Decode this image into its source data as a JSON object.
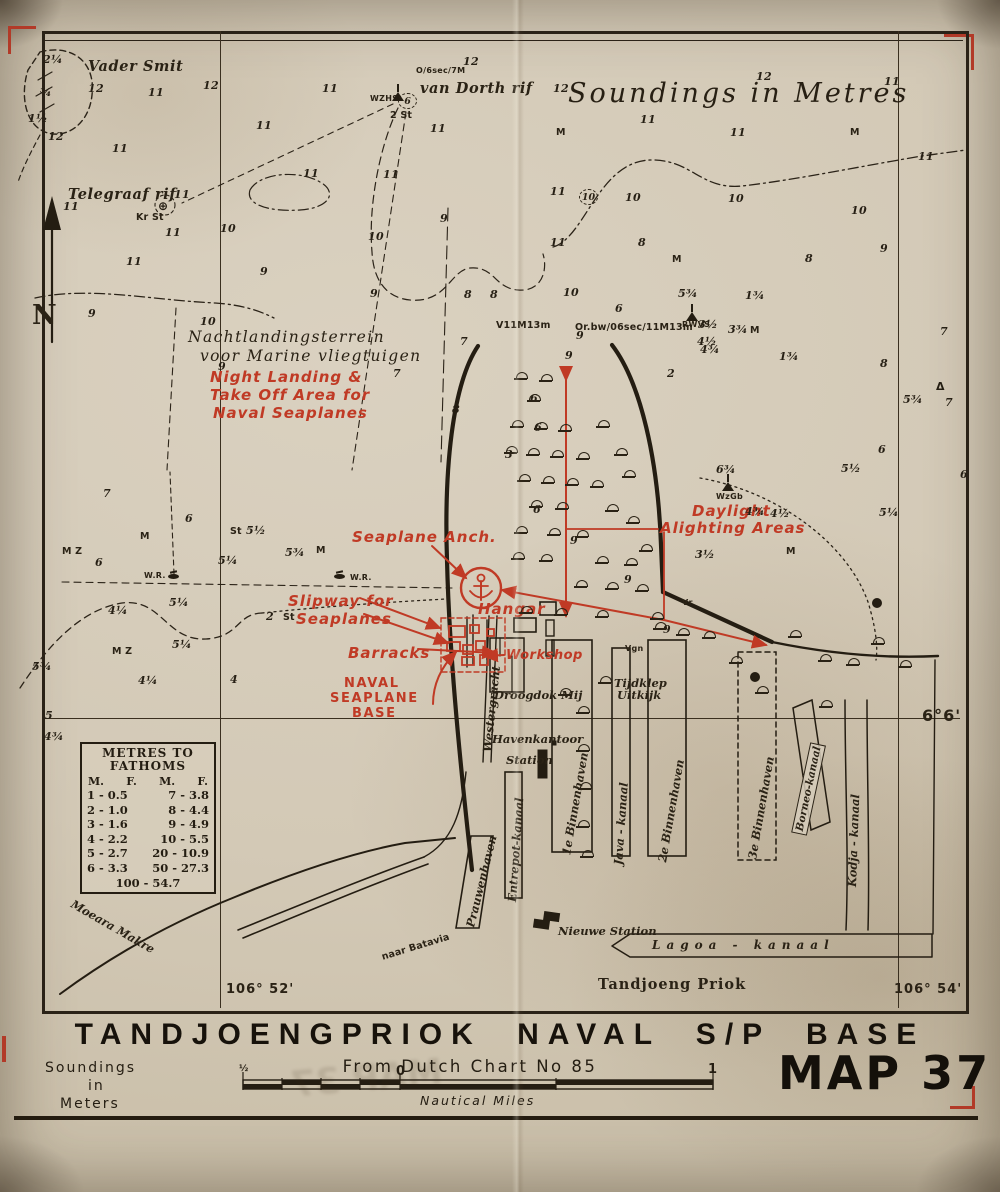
{
  "page": {
    "title": "TANDJOENGPRIOK  NAVAL S/P BASE",
    "source_line": "From Dutch Chart No 85",
    "map_number": "MAP 37",
    "ghost_stamp": "MAP 37",
    "soundings_note": [
      "Soundings",
      "in",
      "Meters"
    ],
    "scale": {
      "half_label": "½",
      "zero_label": "0",
      "one_label": "1",
      "units": "Nautical Miles"
    }
  },
  "map": {
    "sea_title": "Soundings in Metres",
    "graticule": {
      "parallel": "6°6'",
      "meridian_left": "106° 52'",
      "meridian_right": "106° 54'",
      "north": "N"
    },
    "colors": {
      "paper": "#d3c9b6",
      "ink": "#2a2217",
      "red": "#c03a25"
    },
    "fathom_table": {
      "title": [
        "METRES TO",
        "FATHOMS"
      ],
      "headers": [
        "M.",
        "F.",
        "M.",
        "F."
      ],
      "rows": [
        [
          "1 - 0.5",
          "7 -  3.8"
        ],
        [
          "2 - 1.0",
          "8 -  4.4"
        ],
        [
          "3 - 1.6",
          "9 -  4.9"
        ],
        [
          "4 - 2.2",
          "10 -  5.5"
        ],
        [
          "5 - 2.7",
          "20 - 10.9"
        ],
        [
          "6 - 3.3",
          "50 - 27.3"
        ]
      ],
      "footer": "100 - 54.7"
    },
    "symbol_glyphs": {
      "ring": "⊕",
      "delta": "Δ"
    },
    "texts": [
      {
        "t": "Vader Smit",
        "x": 88,
        "y": 58,
        "c": "nml"
      },
      {
        "t": "Telegraaf rif",
        "x": 68,
        "y": 186,
        "c": "nml"
      },
      {
        "t": "van Dorth rif",
        "x": 420,
        "y": 80,
        "c": "nml"
      },
      {
        "t": "O/6sec/7M",
        "x": 416,
        "y": 66,
        "c": "mic"
      },
      {
        "t": "WZHS",
        "x": 370,
        "y": 94,
        "c": "mic"
      },
      {
        "t": "2 St",
        "x": 390,
        "y": 110,
        "c": "tin"
      },
      {
        "t": "Kr St",
        "x": 136,
        "y": 212,
        "c": "tin"
      },
      {
        "t": "Soundings in Metres",
        "x": 568,
        "y": 78,
        "c": "sea"
      },
      {
        "t": "Nachtlandingsterrein",
        "x": 188,
        "y": 328,
        "c": "cur"
      },
      {
        "t": "voor Marine vliegtuigen",
        "x": 200,
        "y": 347,
        "c": "cur"
      },
      {
        "t": "V11M13m",
        "x": 496,
        "y": 320,
        "c": "tin"
      },
      {
        "t": "Or.bw/06sec/11M13m",
        "x": 575,
        "y": 322,
        "c": "tin"
      },
      {
        "t": "RWVS",
        "x": 682,
        "y": 320,
        "c": "mic"
      },
      {
        "t": "WzGb",
        "x": 716,
        "y": 492,
        "c": "mic"
      },
      {
        "t": "W.R.",
        "x": 144,
        "y": 571,
        "c": "mic"
      },
      {
        "t": "W.R.",
        "x": 350,
        "y": 573,
        "c": "mic"
      },
      {
        "t": "M Z",
        "x": 62,
        "y": 546,
        "c": "tin"
      },
      {
        "t": "M Z",
        "x": 112,
        "y": 646,
        "c": "tin"
      },
      {
        "t": "St",
        "x": 230,
        "y": 526,
        "c": "tin"
      },
      {
        "t": "St",
        "x": 283,
        "y": 612,
        "c": "tin"
      },
      {
        "t": "Vr",
        "x": 682,
        "y": 598,
        "c": "mic"
      },
      {
        "t": "Vgn",
        "x": 625,
        "y": 644,
        "c": "mic"
      },
      {
        "t": "Droogdok Mij",
        "x": 494,
        "y": 688,
        "c": "nm"
      },
      {
        "t": "Havenkantoor",
        "x": 492,
        "y": 732,
        "c": "nm"
      },
      {
        "t": "Station",
        "x": 506,
        "y": 753,
        "c": "nm"
      },
      {
        "t": "Tijdklep",
        "x": 614,
        "y": 676,
        "c": "nm"
      },
      {
        "t": "Uitkijk",
        "x": 617,
        "y": 688,
        "c": "nm"
      },
      {
        "t": "Nieuwe Station",
        "x": 558,
        "y": 924,
        "c": "nm"
      },
      {
        "t": "Lagoa - kanaal",
        "x": 652,
        "y": 938,
        "c": "nmsp"
      },
      {
        "t": "Tandjoeng Priok",
        "x": 598,
        "y": 976,
        "c": "boldn"
      },
      {
        "t": "Moeara Makre",
        "x": 72,
        "y": 896,
        "c": "nm",
        "r": 30
      },
      {
        "t": "naar Batavia",
        "x": 382,
        "y": 952,
        "c": "tin",
        "r": -17
      },
      {
        "t": "Westergracht",
        "x": 487,
        "y": 745,
        "c": "vert",
        "r": -84
      },
      {
        "t": "Prauwenhaven",
        "x": 470,
        "y": 920,
        "c": "vert",
        "r": -76
      },
      {
        "t": "Entrepot-kanaal",
        "x": 512,
        "y": 895,
        "c": "vert",
        "r": -86
      },
      {
        "t": "1e Binnenhaven",
        "x": 566,
        "y": 848,
        "c": "vert",
        "r": -80
      },
      {
        "t": "Java - kanaal",
        "x": 618,
        "y": 858,
        "c": "vert",
        "r": -86
      },
      {
        "t": "2e Binnenhaven",
        "x": 662,
        "y": 855,
        "c": "vert",
        "r": -80
      },
      {
        "t": "3e Binnenhaven",
        "x": 752,
        "y": 852,
        "c": "vert",
        "r": -80
      },
      {
        "t": "Borneo-kanaal",
        "x": 799,
        "y": 826,
        "c": "vertb",
        "r": -78
      },
      {
        "t": "Kodja - kanaal",
        "x": 852,
        "y": 880,
        "c": "vert",
        "r": -88
      },
      {
        "t": "106° 52'",
        "x": 226,
        "y": 982,
        "c": "coord"
      },
      {
        "t": "106° 54'",
        "x": 894,
        "y": 982,
        "c": "coord"
      },
      {
        "t": "6°6'",
        "x": 922,
        "y": 706,
        "c": "coordl"
      },
      {
        "t": "N",
        "x": 32,
        "y": 300,
        "c": "north"
      },
      {
        "t": "Night Landing &",
        "x": 210,
        "y": 368,
        "c": "redl"
      },
      {
        "t": "Take Off Area for",
        "x": 210,
        "y": 386,
        "c": "redl"
      },
      {
        "t": "Naval Seaplanes",
        "x": 213,
        "y": 404,
        "c": "redl"
      },
      {
        "t": "Seaplane Anch.",
        "x": 352,
        "y": 528,
        "c": "redl"
      },
      {
        "t": "Slipway for",
        "x": 288,
        "y": 592,
        "c": "redl"
      },
      {
        "t": "Seaplanes",
        "x": 296,
        "y": 610,
        "c": "redl"
      },
      {
        "t": "Barracks",
        "x": 348,
        "y": 644,
        "c": "redl"
      },
      {
        "t": "Workshop",
        "x": 506,
        "y": 648,
        "c": "red"
      },
      {
        "t": "Hangar",
        "x": 478,
        "y": 600,
        "c": "redl"
      },
      {
        "t": "NAVAL",
        "x": 344,
        "y": 676,
        "c": "redc"
      },
      {
        "t": "SEAPLANE",
        "x": 330,
        "y": 691,
        "c": "redc"
      },
      {
        "t": "BASE",
        "x": 352,
        "y": 706,
        "c": "redc"
      },
      {
        "t": "Daylight",
        "x": 692,
        "y": 502,
        "c": "redl"
      },
      {
        "t": "Alighting Areas",
        "x": 660,
        "y": 519,
        "c": "redl"
      },
      {
        "t": "12",
        "x": 463,
        "y": 55,
        "c": "d"
      },
      {
        "t": "12",
        "x": 88,
        "y": 82,
        "c": "d"
      },
      {
        "t": "11",
        "x": 148,
        "y": 86,
        "c": "d"
      },
      {
        "t": "12",
        "x": 203,
        "y": 79,
        "c": "d"
      },
      {
        "t": "11",
        "x": 322,
        "y": 82,
        "c": "d"
      },
      {
        "t": "12",
        "x": 553,
        "y": 82,
        "c": "d"
      },
      {
        "t": "12",
        "x": 756,
        "y": 70,
        "c": "d"
      },
      {
        "t": "11",
        "x": 884,
        "y": 75,
        "c": "d"
      },
      {
        "t": "2¼",
        "x": 43,
        "y": 53,
        "c": "d"
      },
      {
        "t": "¾",
        "x": 40,
        "y": 86,
        "c": "d"
      },
      {
        "t": "1½",
        "x": 28,
        "y": 112,
        "c": "d"
      },
      {
        "t": "12",
        "x": 48,
        "y": 130,
        "c": "d"
      },
      {
        "t": "11",
        "x": 112,
        "y": 142,
        "c": "d"
      },
      {
        "t": "11",
        "x": 256,
        "y": 119,
        "c": "d"
      },
      {
        "t": "11",
        "x": 303,
        "y": 167,
        "c": "d"
      },
      {
        "t": "11",
        "x": 383,
        "y": 168,
        "c": "d"
      },
      {
        "t": "11",
        "x": 430,
        "y": 122,
        "c": "d"
      },
      {
        "t": "11",
        "x": 918,
        "y": 150,
        "c": "d"
      },
      {
        "t": "11",
        "x": 63,
        "y": 200,
        "c": "d"
      },
      {
        "t": "11",
        "x": 174,
        "y": 188,
        "c": "d"
      },
      {
        "t": "11",
        "x": 165,
        "y": 226,
        "c": "d"
      },
      {
        "t": "10",
        "x": 220,
        "y": 222,
        "c": "d"
      },
      {
        "t": "11",
        "x": 126,
        "y": 255,
        "c": "d"
      },
      {
        "t": "9",
        "x": 260,
        "y": 265,
        "c": "d"
      },
      {
        "t": "10",
        "x": 368,
        "y": 230,
        "c": "d"
      },
      {
        "t": "9",
        "x": 440,
        "y": 212,
        "c": "d"
      },
      {
        "t": "11",
        "x": 550,
        "y": 185,
        "c": "d"
      },
      {
        "t": "10",
        "x": 625,
        "y": 191,
        "c": "d"
      },
      {
        "t": "10",
        "x": 728,
        "y": 192,
        "c": "d"
      },
      {
        "t": "10",
        "x": 851,
        "y": 204,
        "c": "d"
      },
      {
        "t": "M",
        "x": 556,
        "y": 127,
        "c": "tin"
      },
      {
        "t": "M",
        "x": 850,
        "y": 127,
        "c": "tin"
      },
      {
        "t": "11",
        "x": 640,
        "y": 113,
        "c": "d"
      },
      {
        "t": "11",
        "x": 730,
        "y": 126,
        "c": "d"
      },
      {
        "t": "9",
        "x": 88,
        "y": 307,
        "c": "d"
      },
      {
        "t": "10",
        "x": 200,
        "y": 315,
        "c": "d"
      },
      {
        "t": "9",
        "x": 370,
        "y": 287,
        "c": "d"
      },
      {
        "t": "8",
        "x": 464,
        "y": 288,
        "c": "d"
      },
      {
        "t": "8",
        "x": 490,
        "y": 288,
        "c": "d"
      },
      {
        "t": "10",
        "x": 563,
        "y": 286,
        "c": "d"
      },
      {
        "t": "11",
        "x": 550,
        "y": 236,
        "c": "d"
      },
      {
        "t": "8",
        "x": 638,
        "y": 236,
        "c": "d"
      },
      {
        "t": "M",
        "x": 672,
        "y": 254,
        "c": "tin"
      },
      {
        "t": "5¾",
        "x": 678,
        "y": 287,
        "c": "d"
      },
      {
        "t": "1¾",
        "x": 745,
        "y": 289,
        "c": "d"
      },
      {
        "t": "8",
        "x": 805,
        "y": 252,
        "c": "d"
      },
      {
        "t": "9",
        "x": 880,
        "y": 242,
        "c": "d"
      },
      {
        "t": "7",
        "x": 940,
        "y": 325,
        "c": "d"
      },
      {
        "t": "8",
        "x": 880,
        "y": 357,
        "c": "d"
      },
      {
        "t": "6",
        "x": 615,
        "y": 302,
        "c": "d"
      },
      {
        "t": "9",
        "x": 565,
        "y": 349,
        "c": "d"
      },
      {
        "t": "2",
        "x": 667,
        "y": 367,
        "c": "d"
      },
      {
        "t": "4½",
        "x": 697,
        "y": 335,
        "c": "d"
      },
      {
        "t": "3¾",
        "x": 728,
        "y": 323,
        "c": "d"
      },
      {
        "t": "M",
        "x": 750,
        "y": 325,
        "c": "tin"
      },
      {
        "t": "1¾",
        "x": 779,
        "y": 350,
        "c": "d"
      },
      {
        "t": "9",
        "x": 218,
        "y": 360,
        "c": "d"
      },
      {
        "t": "7",
        "x": 393,
        "y": 367,
        "c": "d"
      },
      {
        "t": "7",
        "x": 460,
        "y": 335,
        "c": "d"
      },
      {
        "t": "8",
        "x": 452,
        "y": 403,
        "c": "d"
      },
      {
        "t": "6",
        "x": 530,
        "y": 392,
        "c": "d"
      },
      {
        "t": "3",
        "x": 505,
        "y": 448,
        "c": "d"
      },
      {
        "t": "6",
        "x": 533,
        "y": 503,
        "c": "d"
      },
      {
        "t": "9",
        "x": 570,
        "y": 534,
        "c": "d"
      },
      {
        "t": "6¾",
        "x": 716,
        "y": 463,
        "c": "d"
      },
      {
        "t": "4¾",
        "x": 745,
        "y": 505,
        "c": "d"
      },
      {
        "t": "5½",
        "x": 841,
        "y": 462,
        "c": "d"
      },
      {
        "t": "5¾",
        "x": 903,
        "y": 393,
        "c": "d"
      },
      {
        "t": "6",
        "x": 960,
        "y": 468,
        "c": "d"
      },
      {
        "t": "6",
        "x": 878,
        "y": 443,
        "c": "d"
      },
      {
        "t": "5¼",
        "x": 879,
        "y": 506,
        "c": "d"
      },
      {
        "t": "7",
        "x": 945,
        "y": 396,
        "c": "d"
      },
      {
        "t": "4½",
        "x": 770,
        "y": 507,
        "c": "d"
      },
      {
        "t": "3½",
        "x": 695,
        "y": 548,
        "c": "d"
      },
      {
        "t": "M",
        "x": 786,
        "y": 546,
        "c": "tin"
      },
      {
        "t": "9",
        "x": 624,
        "y": 573,
        "c": "d"
      },
      {
        "t": "7",
        "x": 103,
        "y": 487,
        "c": "d"
      },
      {
        "t": "6",
        "x": 185,
        "y": 512,
        "c": "d"
      },
      {
        "t": "5½",
        "x": 246,
        "y": 524,
        "c": "d"
      },
      {
        "t": "5¼",
        "x": 218,
        "y": 554,
        "c": "d"
      },
      {
        "t": "5¾",
        "x": 285,
        "y": 546,
        "c": "d"
      },
      {
        "t": "6",
        "x": 95,
        "y": 556,
        "c": "d"
      },
      {
        "t": "5¼",
        "x": 169,
        "y": 596,
        "c": "d"
      },
      {
        "t": "4¼",
        "x": 108,
        "y": 604,
        "c": "d"
      },
      {
        "t": "5¼",
        "x": 172,
        "y": 638,
        "c": "d"
      },
      {
        "t": "4¼",
        "x": 138,
        "y": 674,
        "c": "d"
      },
      {
        "t": "5¾",
        "x": 32,
        "y": 660,
        "c": "d"
      },
      {
        "t": "4",
        "x": 230,
        "y": 673,
        "c": "d"
      },
      {
        "t": "2",
        "x": 266,
        "y": 610,
        "c": "d"
      },
      {
        "t": "5",
        "x": 45,
        "y": 709,
        "c": "d"
      },
      {
        "t": "4¾",
        "x": 44,
        "y": 730,
        "c": "d"
      },
      {
        "t": "9",
        "x": 663,
        "y": 623,
        "c": "d"
      },
      {
        "t": "9",
        "x": 576,
        "y": 329,
        "c": "d"
      },
      {
        "t": "6",
        "x": 534,
        "y": 421,
        "c": "d"
      },
      {
        "t": "M",
        "x": 140,
        "y": 531,
        "c": "tin"
      },
      {
        "t": "M",
        "x": 316,
        "y": 545,
        "c": "tin"
      },
      {
        "t": "3½",
        "x": 698,
        "y": 318,
        "c": "d"
      },
      {
        "t": "4¾",
        "x": 700,
        "y": 343,
        "c": "d"
      }
    ],
    "domes": [
      [
        516,
        372
      ],
      [
        541,
        374
      ],
      [
        529,
        394
      ],
      [
        598,
        420
      ],
      [
        512,
        420
      ],
      [
        536,
        422
      ],
      [
        560,
        424
      ],
      [
        616,
        448
      ],
      [
        506,
        446
      ],
      [
        528,
        448
      ],
      [
        552,
        450
      ],
      [
        578,
        452
      ],
      [
        624,
        470
      ],
      [
        519,
        474
      ],
      [
        543,
        476
      ],
      [
        567,
        478
      ],
      [
        592,
        480
      ],
      [
        531,
        500
      ],
      [
        557,
        502
      ],
      [
        607,
        504
      ],
      [
        516,
        526
      ],
      [
        549,
        528
      ],
      [
        577,
        530
      ],
      [
        628,
        516
      ],
      [
        641,
        544
      ],
      [
        513,
        552
      ],
      [
        541,
        554
      ],
      [
        597,
        556
      ],
      [
        626,
        558
      ],
      [
        576,
        580
      ],
      [
        607,
        582
      ],
      [
        637,
        584
      ],
      [
        521,
        606
      ],
      [
        556,
        608
      ],
      [
        597,
        610
      ],
      [
        652,
        612
      ],
      [
        655,
        622
      ],
      [
        678,
        628
      ],
      [
        704,
        631
      ],
      [
        731,
        656
      ],
      [
        757,
        686
      ],
      [
        790,
        630
      ],
      [
        820,
        654
      ],
      [
        848,
        658
      ],
      [
        873,
        637
      ],
      [
        900,
        660
      ],
      [
        821,
        700
      ],
      [
        578,
        706
      ],
      [
        578,
        744
      ],
      [
        580,
        782
      ],
      [
        578,
        820
      ],
      [
        582,
        850
      ],
      [
        560,
        688
      ],
      [
        600,
        676
      ]
    ],
    "symbols": [
      {
        "k": "beacon",
        "x": 392,
        "y": 92
      },
      {
        "k": "beacon",
        "x": 686,
        "y": 312
      },
      {
        "k": "beacon",
        "x": 722,
        "y": 482
      },
      {
        "k": "circ",
        "x": 579,
        "y": 189,
        "t": "10"
      },
      {
        "k": "circ",
        "x": 398,
        "y": 93,
        "t": "6"
      },
      {
        "k": "wreck",
        "x": 168,
        "y": 574
      },
      {
        "k": "wreck",
        "x": 334,
        "y": 574
      },
      {
        "k": "ring",
        "x": 158,
        "y": 199
      },
      {
        "k": "dotr",
        "x": 750,
        "y": 672
      },
      {
        "k": "dotr",
        "x": 872,
        "y": 598
      },
      {
        "k": "delta",
        "x": 936,
        "y": 380
      }
    ]
  }
}
